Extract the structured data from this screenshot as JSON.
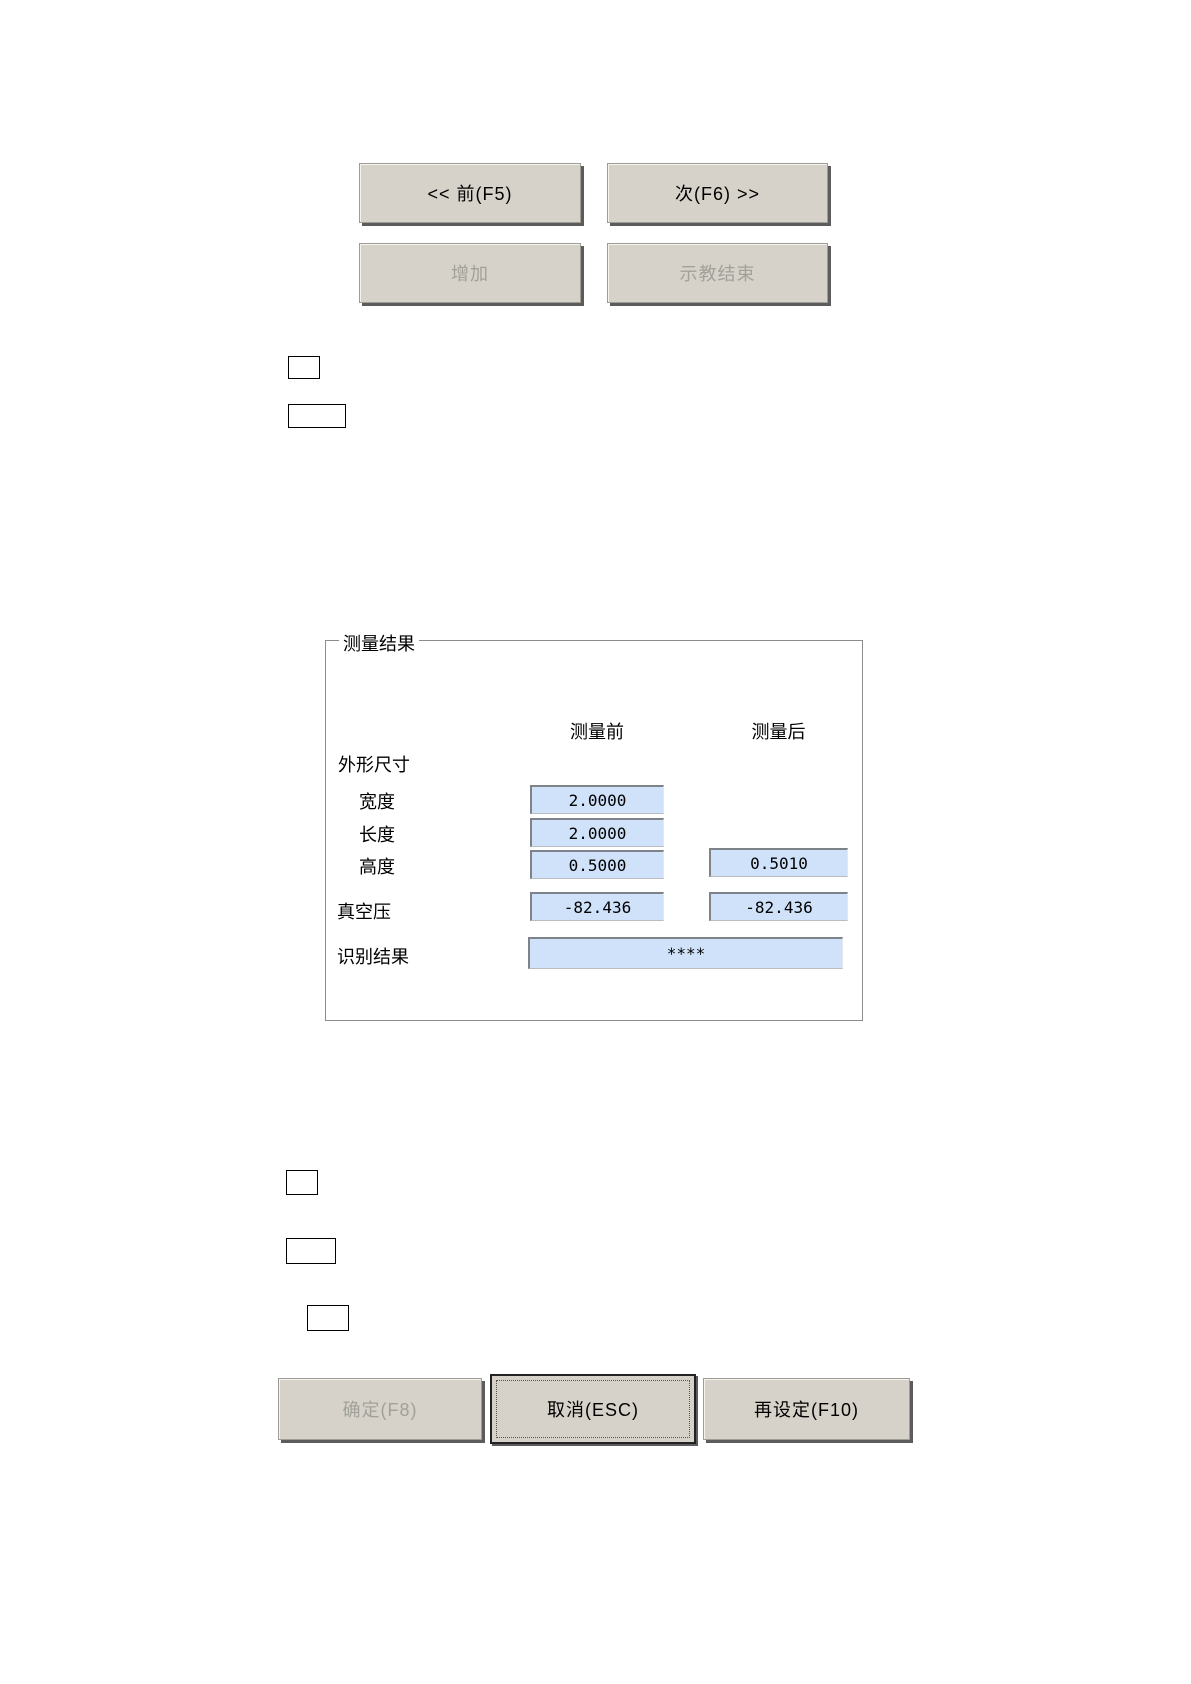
{
  "nav_buttons": {
    "prev": "<< 前(F5)",
    "next": "次(F6) >>",
    "add": "增加",
    "teach_end": "示教结束"
  },
  "measurement_panel": {
    "title": "测量结果",
    "col_before": "测量前",
    "col_after": "测量后",
    "section_dimensions": "外形尺寸",
    "rows": [
      {
        "label": "宽度",
        "before": "2.0000",
        "after": ""
      },
      {
        "label": "长度",
        "before": "2.0000",
        "after": ""
      },
      {
        "label": "高度",
        "before": "0.5000",
        "after": "0.5010"
      }
    ],
    "vacuum": {
      "label": "真空压",
      "before": "-82.436",
      "after": "-82.436"
    },
    "recognition": {
      "label": "识别结果",
      "value": "****"
    }
  },
  "footer_buttons": {
    "ok": "确定(F8)",
    "cancel": "取消(ESC)",
    "reset": "再设定(F10)"
  },
  "colors": {
    "field_background": "#cfe2fa",
    "button_face": "#d6d2ca",
    "button_shadow": "#5c5c5c",
    "disabled_text": "#a1a19a"
  }
}
